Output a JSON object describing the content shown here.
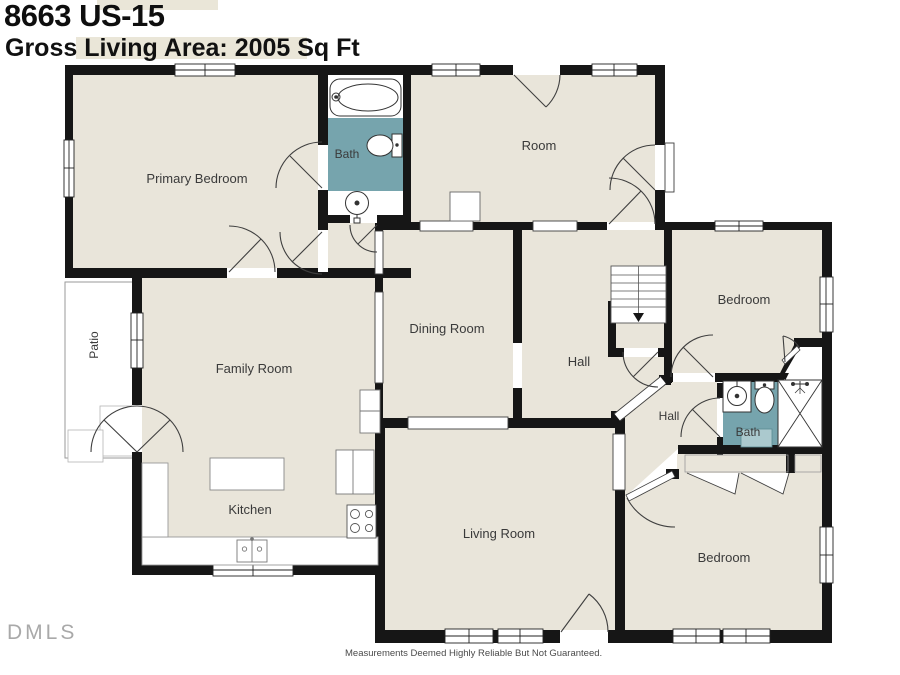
{
  "header": {
    "title": "8663 US-15",
    "subtitle": "Gross Living Area: 2005 Sq Ft"
  },
  "rooms": [
    {
      "id": "primary-bedroom",
      "label": "Primary Bedroom"
    },
    {
      "id": "bath-upper",
      "label": "Bath"
    },
    {
      "id": "room",
      "label": "Room"
    },
    {
      "id": "bedroom-right",
      "label": "Bedroom"
    },
    {
      "id": "patio",
      "label": "Patio"
    },
    {
      "id": "family-room",
      "label": "Family Room"
    },
    {
      "id": "dining-room",
      "label": "Dining Room"
    },
    {
      "id": "hall-upper",
      "label": "Hall"
    },
    {
      "id": "hall-lower",
      "label": "Hall"
    },
    {
      "id": "bath-lower",
      "label": "Bath"
    },
    {
      "id": "kitchen",
      "label": "Kitchen"
    },
    {
      "id": "living-room",
      "label": "Living Room"
    },
    {
      "id": "bedroom-bottom",
      "label": "Bedroom"
    }
  ],
  "fixtures": [
    "bathtub-icon",
    "toilet-icon",
    "sink-icon",
    "shower-icon",
    "staircase",
    "kitchen-island",
    "stove-icon",
    "refrigerator-icon",
    "kitchen-sink-icon",
    "closet-bifold-doors"
  ],
  "footer": {
    "watermark": "DMLS",
    "disclaimer": "Measurements Deemed Highly Reliable But Not Guaranteed."
  },
  "colors": {
    "floor": "#e9e5da",
    "bath_floor": "#76a4ad",
    "bath_mat": "#abc9ce",
    "wall": "#161616",
    "highlight": "#eae6d8"
  }
}
